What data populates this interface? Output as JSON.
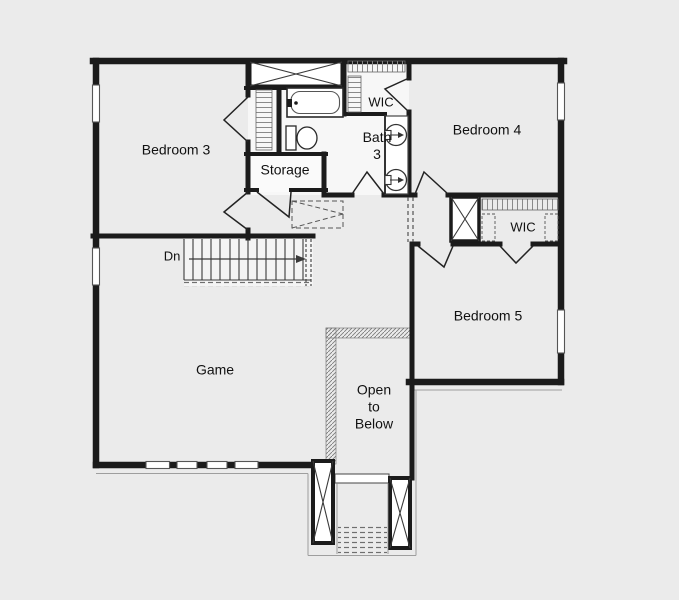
{
  "floor_plan": {
    "labels": {
      "bedroom3": "Bedroom 3",
      "bedroom4": "Bedroom 4",
      "bedroom5": "Bedroom 5",
      "bath3_line1": "Bath",
      "bath3_line2": "3",
      "wic_bedroom4": "WIC",
      "wic_bedroom5": "WIC",
      "storage": "Storage",
      "game": "Game",
      "stair_direction": "Dn",
      "open_to_below_line1": "Open",
      "open_to_below_line2": "to",
      "open_to_below_line3": "Below"
    },
    "colors": {
      "background": "#ebebeb",
      "wall": "#1b1b1b",
      "fixture_line": "#3a3a3a",
      "hatch": "#8a8a8a",
      "text": "#111111"
    }
  }
}
